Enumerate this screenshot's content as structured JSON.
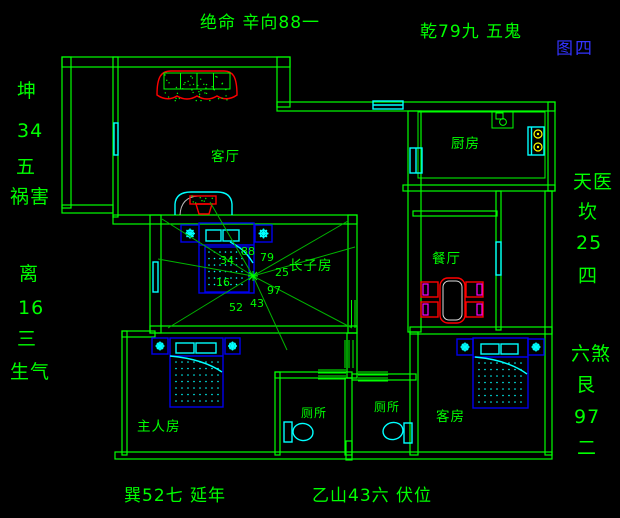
{
  "figure_tag": "图四",
  "directions": {
    "top_center": "绝命  辛向88一",
    "top_right": "乾79九  五鬼",
    "left_upper": {
      "chars": [
        "坤",
        "34",
        "五",
        "祸害"
      ]
    },
    "left_lower": {
      "chars": [
        "离",
        "16",
        "三",
        "生气"
      ]
    },
    "right_upper": {
      "chars": [
        "天医",
        "坎",
        "25",
        "四"
      ]
    },
    "right_lower": {
      "chars": [
        "六煞",
        "艮",
        "97",
        "二"
      ]
    },
    "bottom_left": "巽52七  延年",
    "bottom_center": "乙山43六  伏位"
  },
  "rooms": {
    "living": "客厅",
    "kitchen": "厨房",
    "dining": "餐厅",
    "eldest_son": "长子房",
    "master": "主人房",
    "toilet1": "厕所",
    "toilet2": "厕所",
    "guest": "客房"
  },
  "compass_numbers": {
    "n88": "88",
    "n79": "79",
    "n25": "25",
    "n97": "97",
    "n43": "43",
    "n52": "52",
    "n16": "16",
    "n34": "34"
  },
  "colors": {
    "wall_green": "#00ff00",
    "window_cyan": "#00ffff",
    "furniture_red": "#ff0000",
    "bed_blue": "#0000ee",
    "cushion_magenta": "#ff00ff",
    "burner_yellow": "#ffff00",
    "figure_blue": "#3333ff",
    "background": "#000000"
  }
}
